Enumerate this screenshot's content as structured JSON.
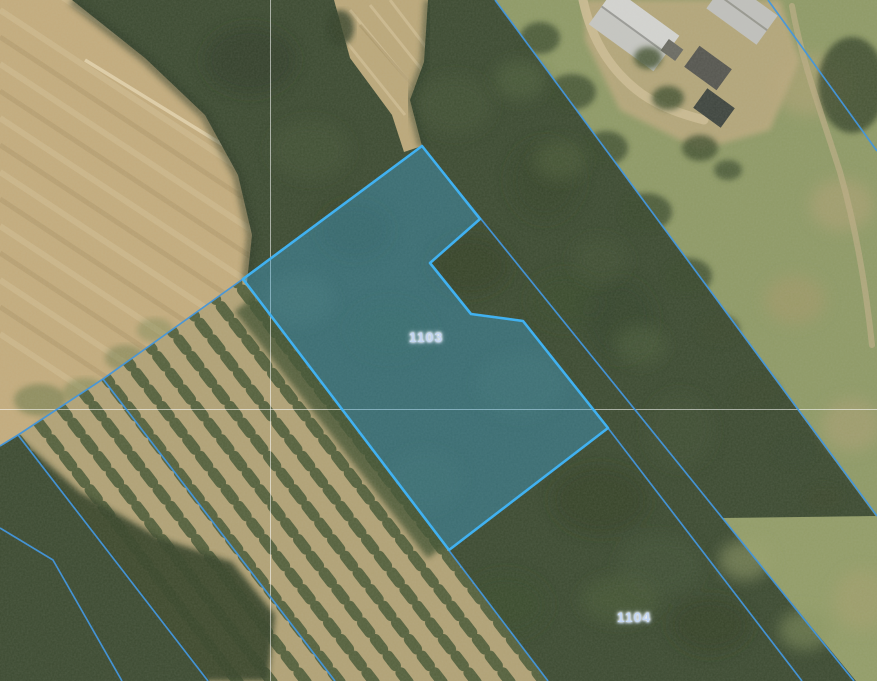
{
  "map": {
    "parcel_labels": [
      {
        "number": "1103",
        "selected": true
      },
      {
        "number": "1104",
        "selected": false
      }
    ],
    "colors": {
      "boundary_line": "#4496dc",
      "selected_outline": "#41b1f0",
      "selected_fill": "rgba(62,168,222,0.38)",
      "grid_line": "rgba(255,255,255,0.55)",
      "label_color": "#c3d6f2"
    }
  }
}
